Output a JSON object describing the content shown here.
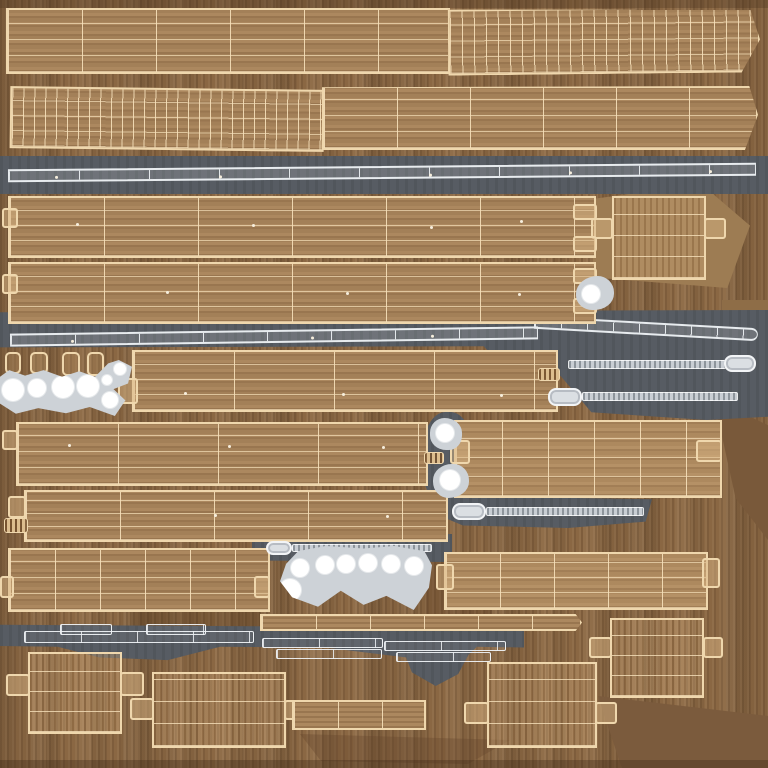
{
  "canvas": {
    "width": 768,
    "height": 768
  },
  "content_kind": "uv-texture-atlas",
  "visible_text": [],
  "palette": {
    "wood_bg": "#8a6743",
    "wood_plank": "#a5825a",
    "wood_light": "#b08d62",
    "wood_dark": "#79593a",
    "wood_facet_light": "#9d7c53",
    "wire_tan": "#efd7ad",
    "gray_band": "#575c63",
    "runner_white": "#e8ecef",
    "metal_light": "#c9ced4",
    "paddle": "#dbdfe3",
    "blob_gray": "#cdd2d7",
    "hole_white": "#ffffff",
    "dot_light": "#f6eedd"
  },
  "pieces": [
    {
      "n": "facet-shade-behind-box",
      "t": "facet",
      "x": 588,
      "y": 184,
      "w": 162,
      "h": 104,
      "c": "#9d7c53",
      "clip": "polygon(0% 15%, 70% 0%, 100% 40%, 86% 100%, 4% 90%)"
    },
    {
      "n": "facet-shade-right",
      "t": "facet",
      "x": 714,
      "y": 400,
      "w": 54,
      "h": 140,
      "c": "#79593a",
      "clip": "polygon(0% 0%, 100% 18%, 100% 100%, 40% 70%)"
    },
    {
      "n": "facet-shade-bottom-right",
      "t": "facet",
      "x": 598,
      "y": 688,
      "w": 170,
      "h": 80,
      "c": "#7b5b3d",
      "clip": "polygon(0% 10%, 100% 35%, 100% 100%, 14% 100%)"
    },
    {
      "n": "facet-shade-mid",
      "t": "facet",
      "x": 426,
      "y": 556,
      "w": 66,
      "h": 88,
      "c": "rgba(85,57,32,0.30)"
    },
    {
      "n": "facet-shade-right-mid",
      "t": "facet",
      "x": 722,
      "y": 300,
      "w": 46,
      "h": 80,
      "c": "#8e6d47"
    },
    {
      "n": "facet-shade-bottom",
      "t": "facet",
      "x": 300,
      "y": 734,
      "w": 210,
      "h": 30,
      "c": "rgba(100,70,42,0.35)",
      "clip": "polygon(0% 0%, 100% 20%, 80% 100%, 10% 90%)"
    },
    {
      "n": "facet-edge-top",
      "t": "facet",
      "x": 0,
      "y": 0,
      "w": 768,
      "h": 8,
      "c": "rgba(70,48,26,0.30)"
    },
    {
      "n": "facet-edge-bottom",
      "t": "facet",
      "x": 0,
      "y": 760,
      "w": 768,
      "h": 8,
      "c": "rgba(60,40,22,0.35)"
    },
    {
      "n": "facet-shade-under-strip",
      "t": "facet",
      "x": 130,
      "y": 612,
      "w": 130,
      "h": 16,
      "c": "rgba(80,52,28,0.30)"
    },
    {
      "n": "metal-band-1",
      "t": "gray",
      "x": 0,
      "y": 156,
      "w": 768,
      "h": 38
    },
    {
      "n": "metal-band-2",
      "t": "gray",
      "x": 0,
      "y": 310,
      "w": 768,
      "h": 110,
      "clip": "polygon(0% 2%, 100% 0%, 100% 97%, 92% 100%, 77% 93%, 73% 60%, 66% 57%, 63% 33%, 0% 34%)"
    },
    {
      "n": "metal-pocket-teardrops",
      "t": "gray",
      "x": 422,
      "y": 412,
      "w": 52,
      "h": 94,
      "rad": "45%"
    },
    {
      "n": "metal-band-3",
      "t": "gray",
      "x": 442,
      "y": 496,
      "w": 210,
      "h": 32,
      "clip": "polygon(0% 25%, 5% 0%, 100% 10%, 97% 80%, 60% 100%, 10% 92%, 0% 65%)"
    },
    {
      "n": "metal-band-4",
      "t": "gray",
      "x": 252,
      "y": 534,
      "w": 200,
      "h": 28,
      "clip": "polygon(0% 30%, 4% 5%, 100% 0%, 100% 100%, 8% 95%, 0% 70%)"
    },
    {
      "n": "metal-band-5",
      "t": "gray",
      "x": 0,
      "y": 624,
      "w": 524,
      "h": 38,
      "clip": "polygon(0% 2%, 100% 10%, 100% 62%, 91% 60%, 88% 100%, 80% 92%, 62% 62%, 42% 60%, 32% 95%, 19% 88%, 11% 60%, 0% 58%)"
    },
    {
      "n": "metal-band-5-drip",
      "t": "gray",
      "x": 404,
      "y": 652,
      "w": 66,
      "h": 34,
      "clip": "polygon(0% 0%, 100% 0%, 82% 65%, 48% 100%, 12% 60%)"
    },
    {
      "n": "uv-plank-top-left",
      "t": "wood",
      "x": 6,
      "y": 8,
      "w": 444,
      "h": 66,
      "gx": 74,
      "gy": 16
    },
    {
      "n": "uv-plank-top-right-curved",
      "t": "wood",
      "x": 448,
      "y": 8,
      "w": 312,
      "h": 66,
      "gx": 12,
      "gy": 16,
      "r": -0.6,
      "clip": "polygon(0% 0%, 97% 5%, 100% 50%, 94% 100%, 0% 100%)"
    },
    {
      "n": "uv-plank-2-left-curved",
      "t": "wood",
      "x": 10,
      "y": 88,
      "w": 314,
      "h": 62,
      "gx": 11,
      "gy": 15,
      "r": 0.7
    },
    {
      "n": "uv-plank-2-right",
      "t": "wood",
      "x": 322,
      "y": 86,
      "w": 436,
      "h": 64,
      "gx": 73,
      "gy": 16,
      "clip": "polygon(0% 2%, 98% 0%, 100% 45%, 97% 100%, 0% 100%)"
    },
    {
      "n": "runner-strip-1",
      "t": "runner",
      "x": 8,
      "y": 166,
      "w": 748,
      "h": 13,
      "seg": 70,
      "r": -0.5,
      "dots": [
        [
          46,
          5
        ],
        [
          210,
          6
        ],
        [
          420,
          6
        ],
        [
          560,
          5
        ],
        [
          700,
          5
        ]
      ]
    },
    {
      "n": "uv-plank-3",
      "t": "wood",
      "x": 8,
      "y": 196,
      "w": 588,
      "h": 62,
      "gx": 94,
      "gy": 15,
      "dots": [
        [
          66,
          25
        ],
        [
          242,
          26
        ],
        [
          420,
          28
        ],
        [
          510,
          22
        ]
      ]
    },
    {
      "n": "uv-plank-4",
      "t": "wood",
      "x": 8,
      "y": 262,
      "w": 588,
      "h": 62,
      "gx": 94,
      "gy": 15,
      "dots": [
        [
          156,
          27
        ],
        [
          336,
          28
        ],
        [
          508,
          29
        ]
      ]
    },
    {
      "n": "box-unwrap-top-right",
      "t": "wirebox",
      "x": 612,
      "y": 196,
      "w": 94,
      "h": 84,
      "gy": 21
    },
    {
      "n": "tab",
      "t": "tab",
      "x": 591,
      "y": 218,
      "w": 22,
      "h": 21
    },
    {
      "n": "tab",
      "t": "tab",
      "x": 704,
      "y": 218,
      "w": 22,
      "h": 21
    },
    {
      "n": "tab",
      "t": "tab",
      "x": 2,
      "y": 208,
      "w": 16,
      "h": 20
    },
    {
      "n": "tab",
      "t": "tab",
      "x": 573,
      "y": 204,
      "w": 24,
      "h": 16
    },
    {
      "n": "tab",
      "t": "tab",
      "x": 573,
      "y": 236,
      "w": 24,
      "h": 16
    },
    {
      "n": "tab",
      "t": "tab",
      "x": 2,
      "y": 274,
      "w": 16,
      "h": 20
    },
    {
      "n": "tab",
      "t": "tab",
      "x": 573,
      "y": 268,
      "w": 24,
      "h": 16
    },
    {
      "n": "tab",
      "t": "tab",
      "x": 573,
      "y": 298,
      "w": 24,
      "h": 16
    },
    {
      "n": "bracket-teardrop-1",
      "t": "blob",
      "x": 576,
      "y": 276,
      "w": 38,
      "h": 34,
      "rad": "60% 45% 55% 45% / 55% 50% 50% 45%",
      "holes": [
        [
          15,
          18,
          9
        ]
      ]
    },
    {
      "n": "runner-strip-2a",
      "t": "runner",
      "x": 10,
      "y": 330,
      "w": 528,
      "h": 13,
      "seg": 64,
      "r": -0.8,
      "dots": [
        [
          60,
          5
        ],
        [
          300,
          5
        ],
        [
          420,
          5
        ]
      ]
    },
    {
      "n": "runner-strip-2b",
      "t": "runner",
      "x": 534,
      "y": 322,
      "w": 224,
      "h": 13,
      "seg": 26,
      "r": 3.2,
      "rad": "0 8px 8px 0"
    },
    {
      "n": "washer-square",
      "t": "wire",
      "x": 5,
      "y": 352,
      "w": 16,
      "h": 22
    },
    {
      "n": "washer-square",
      "t": "wire",
      "x": 30,
      "y": 352,
      "w": 18,
      "h": 22
    },
    {
      "n": "washer-square",
      "t": "wire",
      "x": 62,
      "y": 352,
      "w": 18,
      "h": 24
    },
    {
      "n": "washer-square",
      "t": "wire",
      "x": 87,
      "y": 352,
      "w": 17,
      "h": 24
    },
    {
      "n": "bracket-plate-left",
      "t": "blob",
      "x": 0,
      "y": 360,
      "w": 132,
      "h": 56,
      "clip": "polygon(0% 30%, 7% 18%, 19% 28%, 33% 18%, 47% 30%, 60% 20%, 72% 30%, 82% 6%, 90% 0%, 100% 12%, 97% 42%, 86% 52%, 95% 72%, 87% 100%, 68% 84%, 50% 95%, 29% 86%, 12% 96%, 0% 78%)",
      "holes": [
        [
          13,
          30,
          11
        ],
        [
          37,
          28,
          9
        ],
        [
          63,
          27,
          11
        ],
        [
          88,
          26,
          11
        ],
        [
          107,
          20,
          5
        ],
        [
          110,
          40,
          8
        ],
        [
          120,
          9,
          6
        ]
      ]
    },
    {
      "n": "uv-plank-5",
      "t": "wood",
      "x": 132,
      "y": 350,
      "w": 426,
      "h": 62,
      "gx": 100,
      "gy": 15,
      "dots": [
        [
          50,
          40
        ],
        [
          208,
          41
        ],
        [
          366,
          42
        ]
      ]
    },
    {
      "n": "tab",
      "t": "tab",
      "x": 118,
      "y": 378,
      "w": 20,
      "h": 26
    },
    {
      "n": "threaded-tip",
      "t": "ribbed",
      "x": 538,
      "y": 368,
      "w": 22,
      "h": 13
    },
    {
      "n": "zip-tie-1-body",
      "t": "tie",
      "x": 568,
      "y": 360,
      "w": 158,
      "h": 9
    },
    {
      "n": "zip-tie-1-head",
      "t": "paddle",
      "x": 724,
      "y": 355,
      "w": 32,
      "h": 17
    },
    {
      "n": "zip-tie-2-head",
      "t": "paddle",
      "x": 548,
      "y": 388,
      "w": 34,
      "h": 18
    },
    {
      "n": "zip-tie-2-body",
      "t": "tie",
      "x": 582,
      "y": 392,
      "w": 156,
      "h": 9
    },
    {
      "n": "uv-plank-6",
      "t": "wood",
      "x": 16,
      "y": 422,
      "w": 412,
      "h": 64,
      "gx": 100,
      "gy": 16,
      "dots": [
        [
          50,
          20
        ],
        [
          210,
          21
        ],
        [
          364,
          22
        ]
      ]
    },
    {
      "n": "tab",
      "t": "tab",
      "x": 2,
      "y": 430,
      "w": 16,
      "h": 20
    },
    {
      "n": "threaded-tip",
      "t": "ribbed",
      "x": 424,
      "y": 452,
      "w": 20,
      "h": 12
    },
    {
      "n": "bracket-teardrop-2",
      "t": "blob",
      "x": 430,
      "y": 418,
      "w": 32,
      "h": 32,
      "rad": "50% 60% 45% 55% / 50%",
      "holes": [
        [
          15,
          15,
          9
        ]
      ]
    },
    {
      "n": "bracket-teardrop-3",
      "t": "blob",
      "x": 433,
      "y": 464,
      "w": 36,
      "h": 34,
      "rad": "55% 45% 60% 45% / 50%",
      "holes": [
        [
          17,
          16,
          10
        ]
      ]
    },
    {
      "n": "uv-plank-mid-right",
      "t": "woodlight",
      "x": 454,
      "y": 420,
      "w": 268,
      "h": 78,
      "gx": 46,
      "gy": 19
    },
    {
      "n": "tab",
      "t": "tab",
      "x": 450,
      "y": 440,
      "w": 20,
      "h": 24
    },
    {
      "n": "tab",
      "t": "tab",
      "x": 696,
      "y": 440,
      "w": 26,
      "h": 22
    },
    {
      "n": "zip-tie-3-head",
      "t": "paddle",
      "x": 452,
      "y": 503,
      "w": 34,
      "h": 17
    },
    {
      "n": "zip-tie-3-body",
      "t": "tie",
      "x": 486,
      "y": 507,
      "w": 158,
      "h": 9
    },
    {
      "n": "uv-plank-7",
      "t": "wood",
      "x": 24,
      "y": 490,
      "w": 424,
      "h": 52,
      "gx": 94,
      "gy": 13,
      "dots": [
        [
          188,
          22
        ],
        [
          360,
          23
        ]
      ]
    },
    {
      "n": "tab",
      "t": "tab",
      "x": 8,
      "y": 496,
      "w": 18,
      "h": 22
    },
    {
      "n": "threaded-tip",
      "t": "ribbed",
      "x": 4,
      "y": 518,
      "w": 24,
      "h": 15
    },
    {
      "n": "zip-tie-4-head",
      "t": "paddle",
      "x": 266,
      "y": 541,
      "w": 26,
      "h": 14
    },
    {
      "n": "zip-tie-4-body",
      "t": "tie",
      "x": 292,
      "y": 544,
      "w": 140,
      "h": 8
    },
    {
      "n": "uv-plank-8-left",
      "t": "wood",
      "x": 8,
      "y": 548,
      "w": 262,
      "h": 64,
      "gx": 45,
      "gy": 16
    },
    {
      "n": "tab",
      "t": "tab",
      "x": 0,
      "y": 576,
      "w": 14,
      "h": 22
    },
    {
      "n": "tab",
      "t": "tab",
      "x": 254,
      "y": 576,
      "w": 16,
      "h": 22
    },
    {
      "n": "bracket-plate-right",
      "t": "blob",
      "x": 280,
      "y": 546,
      "w": 152,
      "h": 64,
      "clip": "polygon(4% 28%, 12% 8%, 30% 0%, 55% 4%, 75% 0%, 95% 8%, 100% 30%, 98% 65%, 88% 100%, 70% 78%, 55% 92%, 40% 70%, 25% 95%, 8% 80%, 0% 55%)",
      "holes": [
        [
          20,
          22,
          9
        ],
        [
          45,
          19,
          9
        ],
        [
          66,
          18,
          9
        ],
        [
          88,
          17,
          9
        ],
        [
          111,
          18,
          9
        ],
        [
          134,
          20,
          9
        ],
        [
          10,
          44,
          11
        ]
      ]
    },
    {
      "n": "uv-plank-8-right",
      "t": "woodlight",
      "x": 444,
      "y": 552,
      "w": 264,
      "h": 58,
      "gx": 54,
      "gy": 15
    },
    {
      "n": "tab",
      "t": "tab",
      "x": 436,
      "y": 564,
      "w": 18,
      "h": 26
    },
    {
      "n": "tab",
      "t": "tab",
      "x": 702,
      "y": 558,
      "w": 18,
      "h": 30
    },
    {
      "n": "thin-slat-strip",
      "t": "strip",
      "x": 260,
      "y": 614,
      "w": 322,
      "h": 17,
      "gx": 54,
      "clip": "polygon(0% 0%, 98% 0%, 100% 50%, 98% 100%, 0% 100%)"
    },
    {
      "n": "flat-strap",
      "t": "wirew",
      "x": 24,
      "y": 631,
      "w": 230,
      "h": 12,
      "gx": 56
    },
    {
      "n": "flat-strap",
      "t": "wirew",
      "x": 60,
      "y": 624,
      "w": 52,
      "h": 11
    },
    {
      "n": "flat-strap",
      "t": "wirew",
      "x": 146,
      "y": 624,
      "w": 60,
      "h": 11
    },
    {
      "n": "flat-strap",
      "t": "wirew",
      "x": 262,
      "y": 638,
      "w": 121,
      "h": 10
    },
    {
      "n": "flat-strap",
      "t": "wirew",
      "x": 276,
      "y": 649,
      "w": 106,
      "h": 10
    },
    {
      "n": "flat-strap",
      "t": "wirew",
      "x": 384,
      "y": 641,
      "w": 122,
      "h": 10
    },
    {
      "n": "flat-strap",
      "t": "wirew",
      "x": 396,
      "y": 652,
      "w": 95,
      "h": 10
    },
    {
      "n": "box-unwrap-a",
      "t": "wirebox",
      "x": 28,
      "y": 652,
      "w": 94,
      "h": 82,
      "gy": 20
    },
    {
      "n": "tab",
      "t": "tab",
      "x": 6,
      "y": 674,
      "w": 24,
      "h": 22
    },
    {
      "n": "tab",
      "t": "tab",
      "x": 120,
      "y": 672,
      "w": 24,
      "h": 24
    },
    {
      "n": "box-unwrap-b",
      "t": "wirebox",
      "x": 152,
      "y": 672,
      "w": 134,
      "h": 76,
      "gy": 22
    },
    {
      "n": "tab",
      "t": "tab",
      "x": 130,
      "y": 698,
      "w": 24,
      "h": 22
    },
    {
      "n": "tab",
      "t": "tab",
      "x": 284,
      "y": 700,
      "w": 20,
      "h": 20
    },
    {
      "n": "slat-piece-c",
      "t": "strip",
      "x": 292,
      "y": 700,
      "w": 134,
      "h": 30,
      "gx": 44
    },
    {
      "n": "box-unwrap-d",
      "t": "wirebox",
      "x": 487,
      "y": 662,
      "w": 110,
      "h": 86,
      "gy": 22
    },
    {
      "n": "tab",
      "t": "tab",
      "x": 464,
      "y": 702,
      "w": 25,
      "h": 22
    },
    {
      "n": "tab",
      "t": "tab",
      "x": 595,
      "y": 702,
      "w": 22,
      "h": 22
    },
    {
      "n": "box-unwrap-e",
      "t": "wirebox",
      "x": 610,
      "y": 618,
      "w": 94,
      "h": 80,
      "gy": 20
    },
    {
      "n": "tab",
      "t": "tab",
      "x": 589,
      "y": 637,
      "w": 23,
      "h": 21
    },
    {
      "n": "tab",
      "t": "tab",
      "x": 703,
      "y": 637,
      "w": 20,
      "h": 21
    }
  ]
}
